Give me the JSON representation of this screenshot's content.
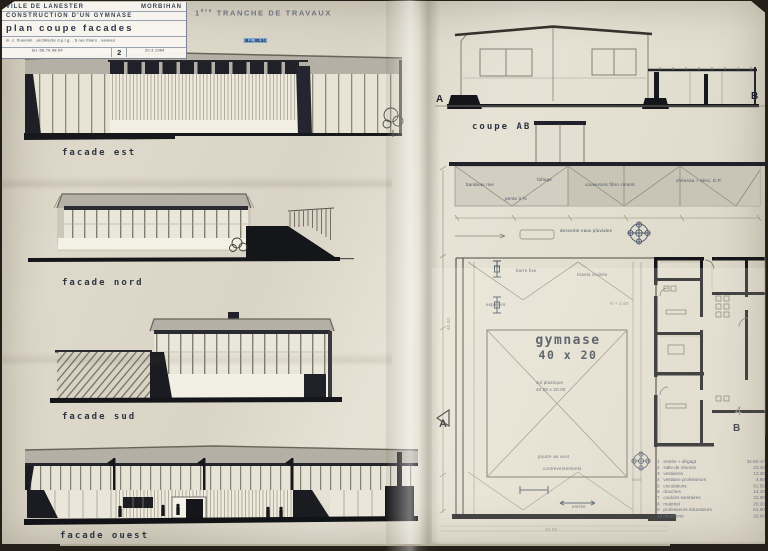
{
  "title_block": {
    "city": "VILLE DE LANESTER",
    "dept": "MORBIHAN",
    "project": "CONSTRUCTION D'UN GYMNASE",
    "sheet_title": "plan coupe facades",
    "architect_line": "m. c. thoumin . architecte d.p.l.g. . 6 rue thiers . vannes",
    "tel_line": "tél. 66.79.98.04",
    "sheet_number": "2",
    "stamp": "B.L. 08.34",
    "date": "20.3.1964"
  },
  "header": {
    "phase_prefix": "1",
    "phase_sup": "ère",
    "phase_rest": "TRANCHE DE TRAVAUX"
  },
  "drawings": {
    "facade_est_label": "facade est",
    "facade_nord_label": "facade nord",
    "facade_sud_label": "facade sud",
    "facade_ouest_label": "facade ouest",
    "coupe_label": "coupe AB",
    "section_marker_a": "A",
    "section_marker_b": "B",
    "plan_marker_a": "A",
    "plan_marker_b": "B",
    "grid_number": "4",
    "hall_name": "gymnase",
    "hall_dims": "40 x 20"
  },
  "annotations": [
    {
      "text": "bandeau rive"
    },
    {
      "text": "faîtage"
    },
    {
      "text": "couverture fibro ciment"
    },
    {
      "text": "chéneau + desc. E.P."
    },
    {
      "text": "pente 3 %"
    },
    {
      "text": "descente eaux pluviales"
    },
    {
      "text": "barre fixe"
    },
    {
      "text": "tirants croisés"
    },
    {
      "text": "espaliers"
    },
    {
      "text": "R + 2.60"
    },
    {
      "text": "sol plastique"
    },
    {
      "text": "40.00 x 20.00"
    },
    {
      "text": "poutre au vent"
    },
    {
      "text": "contreventements"
    },
    {
      "text": "entrée"
    },
    {
      "text": "nord"
    },
    {
      "text": "40.00"
    },
    {
      "text": "20.00"
    }
  ],
  "legend": {
    "items": [
      {
        "num": "1",
        "label": "entrée + dégagt",
        "area": "34.60 m²"
      },
      {
        "num": "2",
        "label": "salle de réunion",
        "area": "23.40"
      },
      {
        "num": "3",
        "label": "vestiaires",
        "area": "13.20"
      },
      {
        "num": "4",
        "label": "vestiaire professeurs",
        "area": "4.60"
      },
      {
        "num": "5",
        "label": "circulations",
        "area": "61.55"
      },
      {
        "num": "6",
        "label": "douches",
        "area": "14.10"
      },
      {
        "num": "7",
        "label": "couloirs sanitaires",
        "area": "31.90"
      },
      {
        "num": "8",
        "label": "matériel",
        "area": "20.20"
      },
      {
        "num": "9",
        "label": "professeurs éducateurs",
        "area": "51.90"
      },
      {
        "num": "10",
        "label": "chaufferie",
        "area": "20.00"
      }
    ]
  },
  "colors": {
    "paper": "#ddd8ca",
    "ink": "#17181c",
    "pencil": "#8e897c",
    "label_ink": "#2e3542",
    "roof_gray": "#b4b0a5",
    "stamp_blue": "#7fa8d0"
  }
}
